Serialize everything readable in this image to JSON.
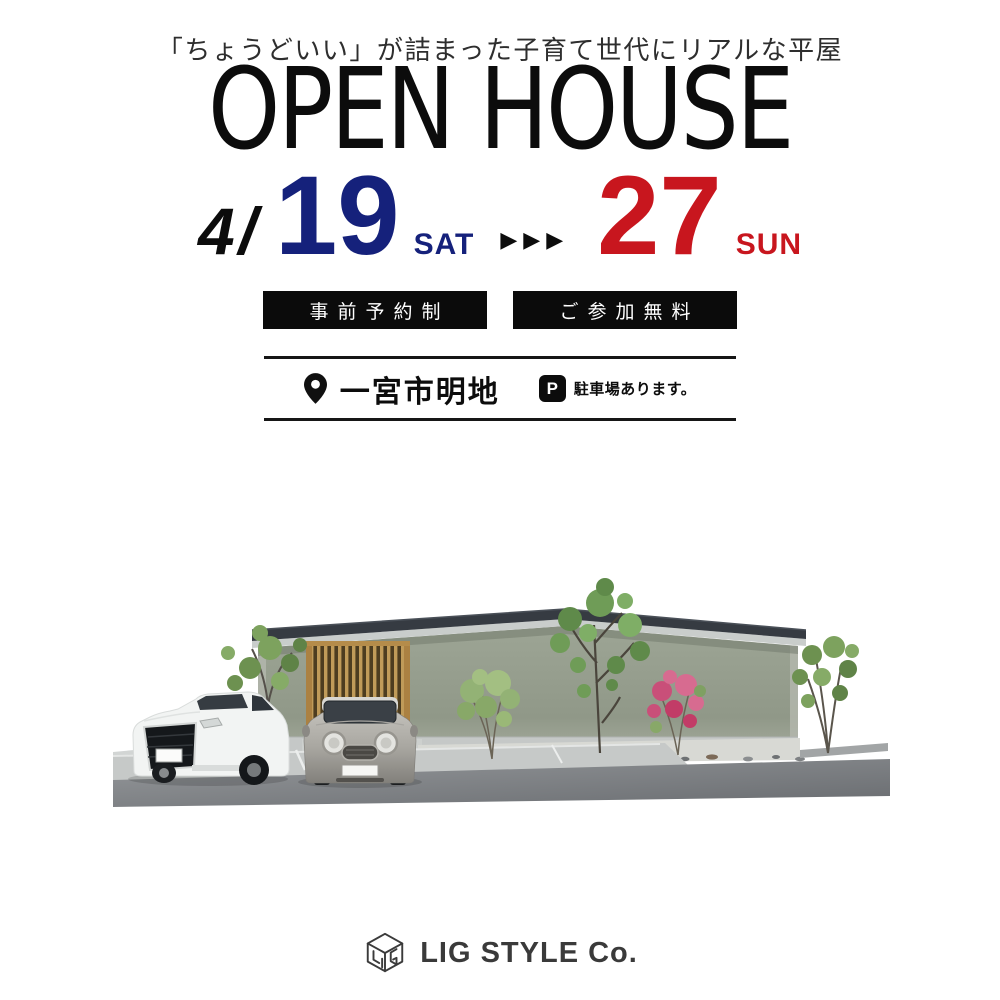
{
  "tagline": "「ちょうどいい」が詰まった子育て世代にリアルな平屋",
  "title": "OPEN HOUSE",
  "date_range": {
    "month": "4",
    "separator": "/",
    "start_day": "19",
    "start_weekday": "SAT",
    "arrows": "▶▶▶",
    "end_day": "27",
    "end_weekday": "SUN"
  },
  "badges": [
    {
      "label": "事前予約制"
    },
    {
      "label": "ご参加無料"
    }
  ],
  "location": {
    "pin_icon": "map-pin-icon",
    "place": "一宮市明地",
    "parking_icon_letter": "P",
    "parking_note": "駐車場あります。"
  },
  "footer": {
    "logo_icon": "cube-outline-icon",
    "company": "LIG STYLE Co."
  },
  "colors": {
    "start_date_blue": "#15217b",
    "end_date_red": "#c8161e",
    "badge_background": "#0b0b0b",
    "text_black": "#0c0c0c",
    "logo_gray": "#3a3a3a"
  },
  "illustration_icons": {
    "scene": "house-exterior-rendering",
    "vehicles": [
      "white-suv",
      "gray-mini-car"
    ]
  }
}
